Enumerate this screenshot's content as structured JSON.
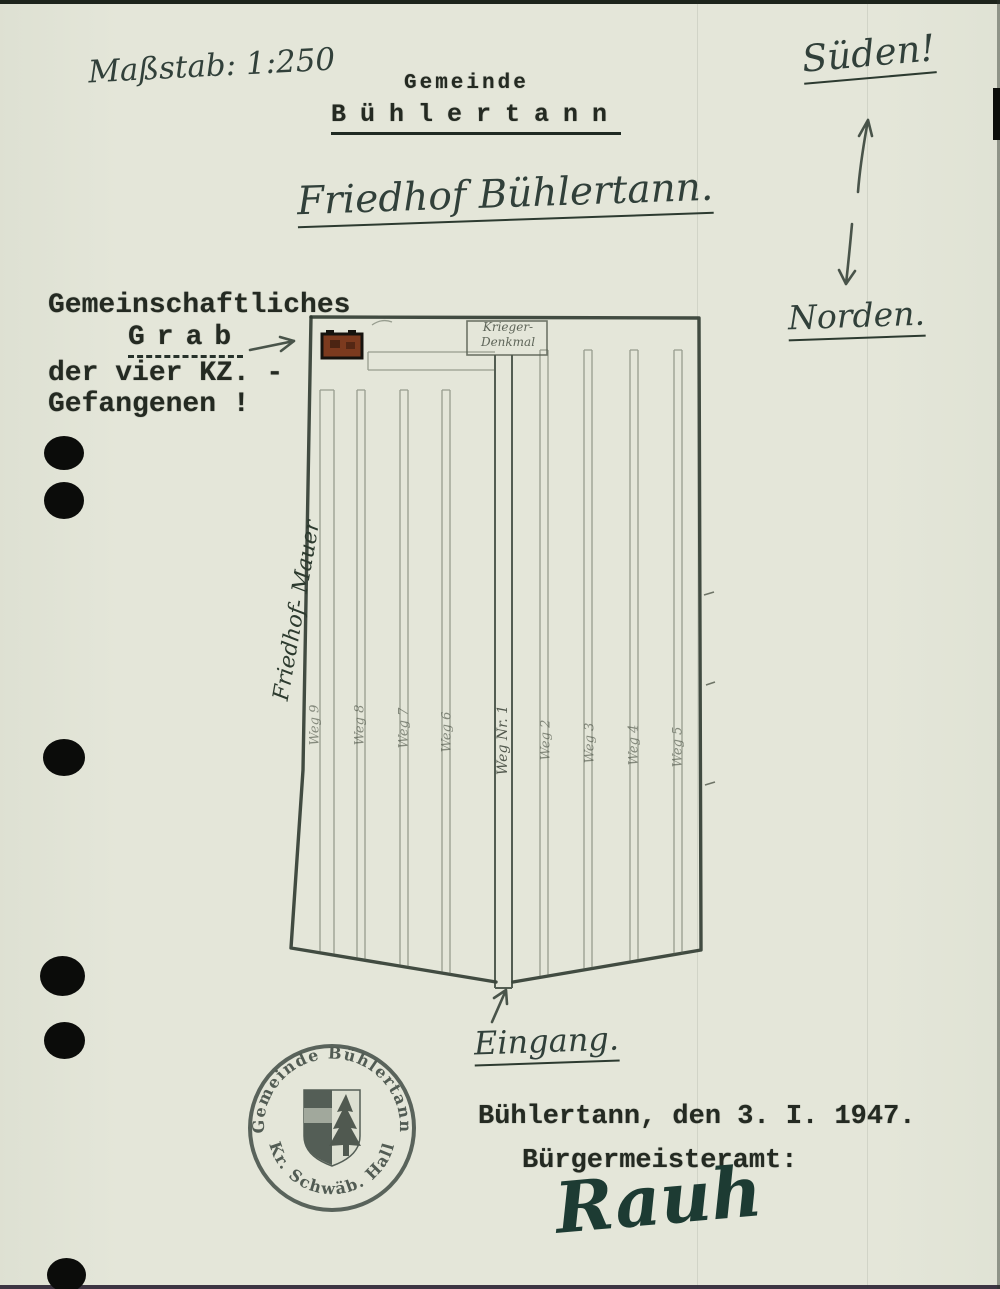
{
  "page": {
    "scale_note": "Maßstab: 1:250",
    "header": {
      "org": "Gemeinde",
      "org_name": "Bühlertann",
      "title": "Friedhof Bühlertann."
    },
    "compass": {
      "south": "Süden!",
      "north": "Norden."
    },
    "grave_note": {
      "line1": "Gemeinschaftliches",
      "line2": "Grab",
      "line3": "der vier KZ. -",
      "line4": "Gefangenen !"
    },
    "plan": {
      "monument_line1": "Krieger-",
      "monument_line2": "Denkmal",
      "wall_label": "Friedhof- Mauer",
      "main_path_label": "Weg Nr. 1",
      "left_path_labels": [
        "Weg 9",
        "Weg 8",
        "Weg 7",
        "Weg 6"
      ],
      "right_path_labels": [
        "Weg 2",
        "Weg 3",
        "Weg 4",
        "Weg 5"
      ],
      "entrance_label": "Eingang."
    },
    "stamp": {
      "arc_top": "Gemeinde Bühlertann",
      "arc_bottom": "* Kr. Schwäb. Hall *"
    },
    "footer": {
      "place_date": "Bühlertann, den 3. I. 1947.",
      "office": "Bürgermeisteramt:",
      "signature": "Rauh"
    },
    "colors": {
      "paper": "#e4e6d9",
      "ink_handwriting": "#31403a",
      "ink_typewriter": "#242a22",
      "pencil": "#6b7365",
      "grave_marker": "#7c3a1e",
      "signature_ink": "#1d3b33"
    }
  }
}
